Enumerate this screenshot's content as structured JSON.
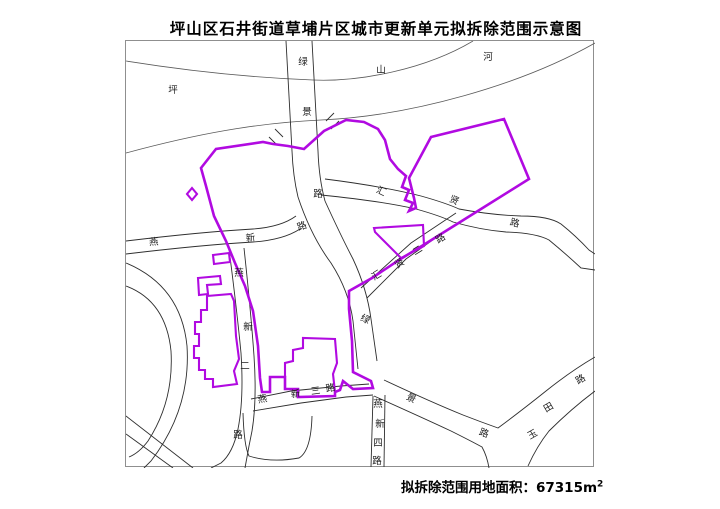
{
  "title": "坪山区石井街道草埔片区城市更新单元拟拆除范围示意图",
  "footer": {
    "area_label": "拟拆除范围用地面积：",
    "area_value": "67315",
    "area_unit_base": "m",
    "area_unit_sup": "2"
  },
  "map": {
    "colors": {
      "frame": "#8f8f8f",
      "road": "#2e2e2e",
      "river": "#5a5a5a",
      "boundary": "#b10ae1",
      "label": "#1c1c1c"
    },
    "rivers": [
      "M125,60 C200,72 260,77 312,79 C360,81 425,68 472,40",
      "M125,152 C195,133 255,122 320,119 C410,115 520,84 594,42"
    ],
    "roads": [
      "M285,40 L291,150 Q292,175 297,196",
      "M311,40 L317,150 Q318,178 324,200",
      "M297,196 Q310,235 330,262 Q348,290 352,320 L357,368",
      "M324,200 Q340,235 352,258 Q366,288 370,318 L376,360",
      "M383,379 Q430,401 462,414 Q480,421 497,427 Q520,410 545,390 Q570,370 594,356",
      "M373,395 Q420,416 450,430 Q470,440 481,446 Q486,455 488,467",
      "M527,465 Q536,445 548,430 Q570,408 594,390",
      "M324,178 Q380,185 420,195 Q445,202 458,208 Q490,214 520,215 Q548,215 560,223 Q575,235 588,249 L594,253",
      "M320,194 Q380,200 415,208 Q440,215 452,221 Q480,229 505,231 Q535,232 548,239 Q565,253 580,267 L594,269",
      "M455,212 L410,242 L360,287",
      "M450,226 L405,258 L366,297",
      "M125,240 Q200,231 252,228 Q280,226 295,215",
      "M125,253 Q200,244 252,241 Q282,239 299,228",
      "M228,248 Q236,310 240,352 Q243,398 237,428 Q232,452 220,462 L210,467",
      "M243,247 Q250,312 253,355 Q256,400 251,430 L248,445 L244,467",
      "M250,398 L290,390 L340,385 L368,383",
      "M252,410 L300,402 L345,396 L372,394",
      "M372,395 L370,466",
      "M384,394 L383,466",
      "M242,412 Q243,445 248,455 Q270,462 298,457 Q310,450 311,415",
      "M125,415 L192,467",
      "M125,433 L172,467",
      "M125,262 Q180,285 186,345 Q190,408 150,460 L143,467",
      "M125,285 Q165,300 170,350 Q173,400 147,440 Q138,452 128,456"
    ],
    "ticks": [
      "M274,128 L282,136",
      "M268,136 L276,144",
      "M325,120 L333,112",
      "M330,128 L338,120"
    ],
    "boundary": {
      "main_loop": "M200,167 L215,148 L262,141 L272,143 L287,145 L303,148 L323,130 L345,119 L363,121 L377,128 L384,139 L389,158 L397,168 L405,175 L401,186 L408,189 L404,199 L412,202 L408,210 L415,207 L413,197 L408,177 L430,136 L503,118 L528,178 L480,208 L448,228 L424,243 L398,259 L371,277 L348,290 L348,308 L351,340 L352,371 L370,380 L372,387 L352,388 L342,380 L339,389 L334,391 L334,395 L297,396 L297,388 L284,388 L284,376 L269,376 L269,391 L261,391 L259,377 L257,345 L252,310 L244,285 L234,262 L225,240 L213,215 L205,185 Z",
      "extras": [
        "M284,376 L284,362 L292,360 L292,349 L302,347 L302,337 L334,338 L336,362 L332,373 L334,391",
        "M206,295 L230,293 L233,300 L235,335 L238,358 L233,370 L236,383 L212,386 L212,378 L204,378 L204,369 L198,369 L198,357 L193,357 L193,345 L198,345 L198,333 L194,333 L194,321 L200,321 L200,309 L206,309 Z",
        "M197,277 L219,275 L220,283 L206,284 L207,293 L198,294 Z",
        "M212,254 L228,252 L229,261 L213,263 Z",
        "M191,187 L196,193 L191,199 L186,193 Z",
        "M373,227 L422,224 L423,245 L400,257 L374,231 Z"
      ]
    },
    "labels": [
      {
        "t": "坪",
        "x": 172,
        "y": 92,
        "r": 0
      },
      {
        "t": "山",
        "x": 380,
        "y": 72,
        "r": 0
      },
      {
        "t": "河",
        "x": 487,
        "y": 59,
        "r": 0
      },
      {
        "t": "绿",
        "x": 302,
        "y": 64,
        "r": 0
      },
      {
        "t": "景",
        "x": 306,
        "y": 114,
        "r": 0
      },
      {
        "t": "路",
        "x": 317,
        "y": 196,
        "r": 0
      },
      {
        "t": "燕",
        "x": 153,
        "y": 244,
        "r": -5
      },
      {
        "t": "新",
        "x": 250,
        "y": 240,
        "r": -8
      },
      {
        "t": "路",
        "x": 302,
        "y": 228,
        "r": -20
      },
      {
        "t": "汇",
        "x": 379,
        "y": 193,
        "r": 25
      },
      {
        "t": "贤",
        "x": 452,
        "y": 202,
        "r": 25
      },
      {
        "t": "路",
        "x": 513,
        "y": 225,
        "r": 15
      },
      {
        "t": "汇",
        "x": 377,
        "y": 277,
        "r": -32
      },
      {
        "t": "贤",
        "x": 400,
        "y": 265,
        "r": -32
      },
      {
        "t": "二",
        "x": 418,
        "y": 252,
        "r": -32
      },
      {
        "t": "路",
        "x": 441,
        "y": 240,
        "r": -32
      },
      {
        "t": "绿",
        "x": 363,
        "y": 321,
        "r": 25
      },
      {
        "t": "景",
        "x": 409,
        "y": 400,
        "r": 25
      },
      {
        "t": "路",
        "x": 482,
        "y": 435,
        "r": 20
      },
      {
        "t": "燕",
        "x": 238,
        "y": 275,
        "r": 0
      },
      {
        "t": "新",
        "x": 247,
        "y": 329,
        "r": 0
      },
      {
        "t": "二",
        "x": 244,
        "y": 368,
        "r": 0
      },
      {
        "t": "路",
        "x": 237,
        "y": 437,
        "r": 0
      },
      {
        "t": "燕",
        "x": 262,
        "y": 401,
        "r": -10
      },
      {
        "t": "新",
        "x": 295,
        "y": 396,
        "r": -8
      },
      {
        "t": "三",
        "x": 315,
        "y": 393,
        "r": -8
      },
      {
        "t": "路",
        "x": 330,
        "y": 390,
        "r": -10
      },
      {
        "t": "燕",
        "x": 377,
        "y": 406,
        "r": 0
      },
      {
        "t": "新",
        "x": 379,
        "y": 426,
        "r": 0
      },
      {
        "t": "四",
        "x": 377,
        "y": 445,
        "r": 0
      },
      {
        "t": "路",
        "x": 376,
        "y": 463,
        "r": 0
      },
      {
        "t": "玉",
        "x": 533,
        "y": 436,
        "r": -30
      },
      {
        "t": "田",
        "x": 549,
        "y": 409,
        "r": -30
      },
      {
        "t": "路",
        "x": 581,
        "y": 381,
        "r": -30
      }
    ]
  }
}
